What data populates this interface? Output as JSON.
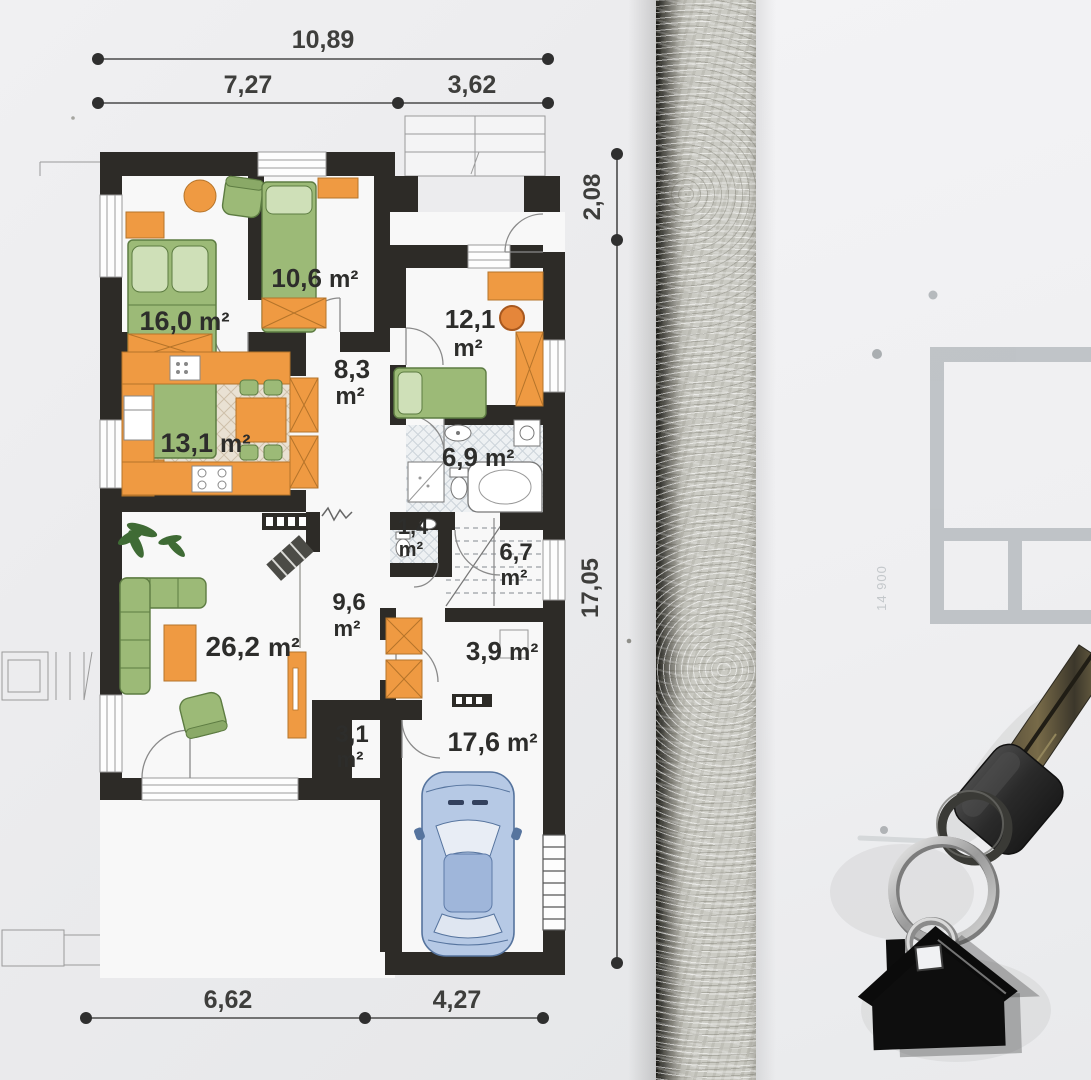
{
  "plan": {
    "dimensions": {
      "top_total": "10,89",
      "top_left": "7,27",
      "top_right": "3,62",
      "right_top": "2,08",
      "right_main": "17,05",
      "bottom_left": "6,62",
      "bottom_right": "4,27"
    },
    "rooms": [
      {
        "id": "bedroom",
        "value": "16,0",
        "unit": "m²"
      },
      {
        "id": "room-10-6",
        "value": "10,6",
        "unit": "m²"
      },
      {
        "id": "room-12-1",
        "value": "12,1",
        "unit": "m²"
      },
      {
        "id": "hall",
        "value": "8,3",
        "unit": "m²"
      },
      {
        "id": "kitchen",
        "value": "13,1",
        "unit": "m²"
      },
      {
        "id": "bathroom",
        "value": "6,9",
        "unit": "m²"
      },
      {
        "id": "wc",
        "value": "1,4",
        "unit": "m²"
      },
      {
        "id": "stairs",
        "value": "6,7",
        "unit": "m²"
      },
      {
        "id": "corridor",
        "value": "9,6",
        "unit": "m²"
      },
      {
        "id": "living-room",
        "value": "26,2",
        "unit": "m²"
      },
      {
        "id": "storage",
        "value": "3,9",
        "unit": "m²"
      },
      {
        "id": "vestibule",
        "value": "3,1",
        "unit": "m²"
      },
      {
        "id": "garage",
        "value": "17,6",
        "unit": "m²"
      }
    ]
  },
  "background_sheet": {
    "scale_text": "14 900"
  },
  "colors": {
    "wall": "#2d2b27",
    "furniture_orange": "#ef9a42",
    "furniture_green": "#9cba77",
    "car_blue": "#b6c9e5",
    "kitchen_floor": "#e9e1d3",
    "bath_floor": "#eef1f3",
    "concrete": "#cbcbc4",
    "keychain_black": "#121212",
    "dimension_text": "#3e3e3c"
  }
}
